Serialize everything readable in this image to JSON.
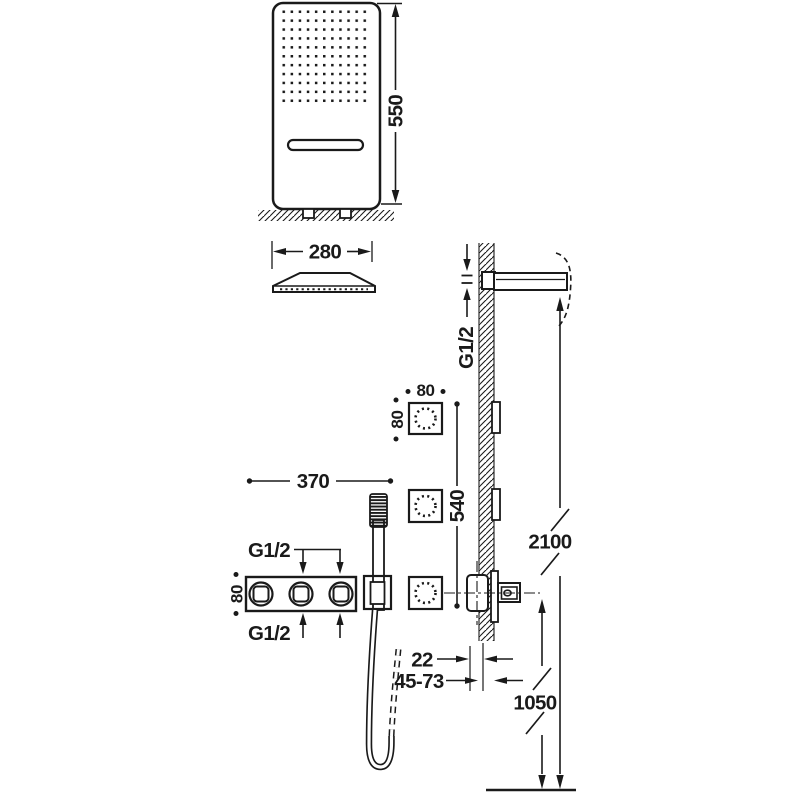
{
  "figure": {
    "kind": "shower-system-installation-dimension-drawing",
    "line_color": "#1a1a1a",
    "background_color": "#ffffff"
  },
  "labels": {
    "panel_height": "550",
    "panel_width": "280",
    "arm_thread": "G1/2",
    "jet_width": "80",
    "jet_height": "80",
    "jet_span": "540",
    "mixer_width": "370",
    "mixer_height": "80",
    "mixer_thread_top": "G1/2",
    "mixer_thread_bottom": "G1/2",
    "spout_projection": "22",
    "recess_depth": "45-73",
    "outlet_floor_height": "1050",
    "arm_floor_height": "2100"
  }
}
